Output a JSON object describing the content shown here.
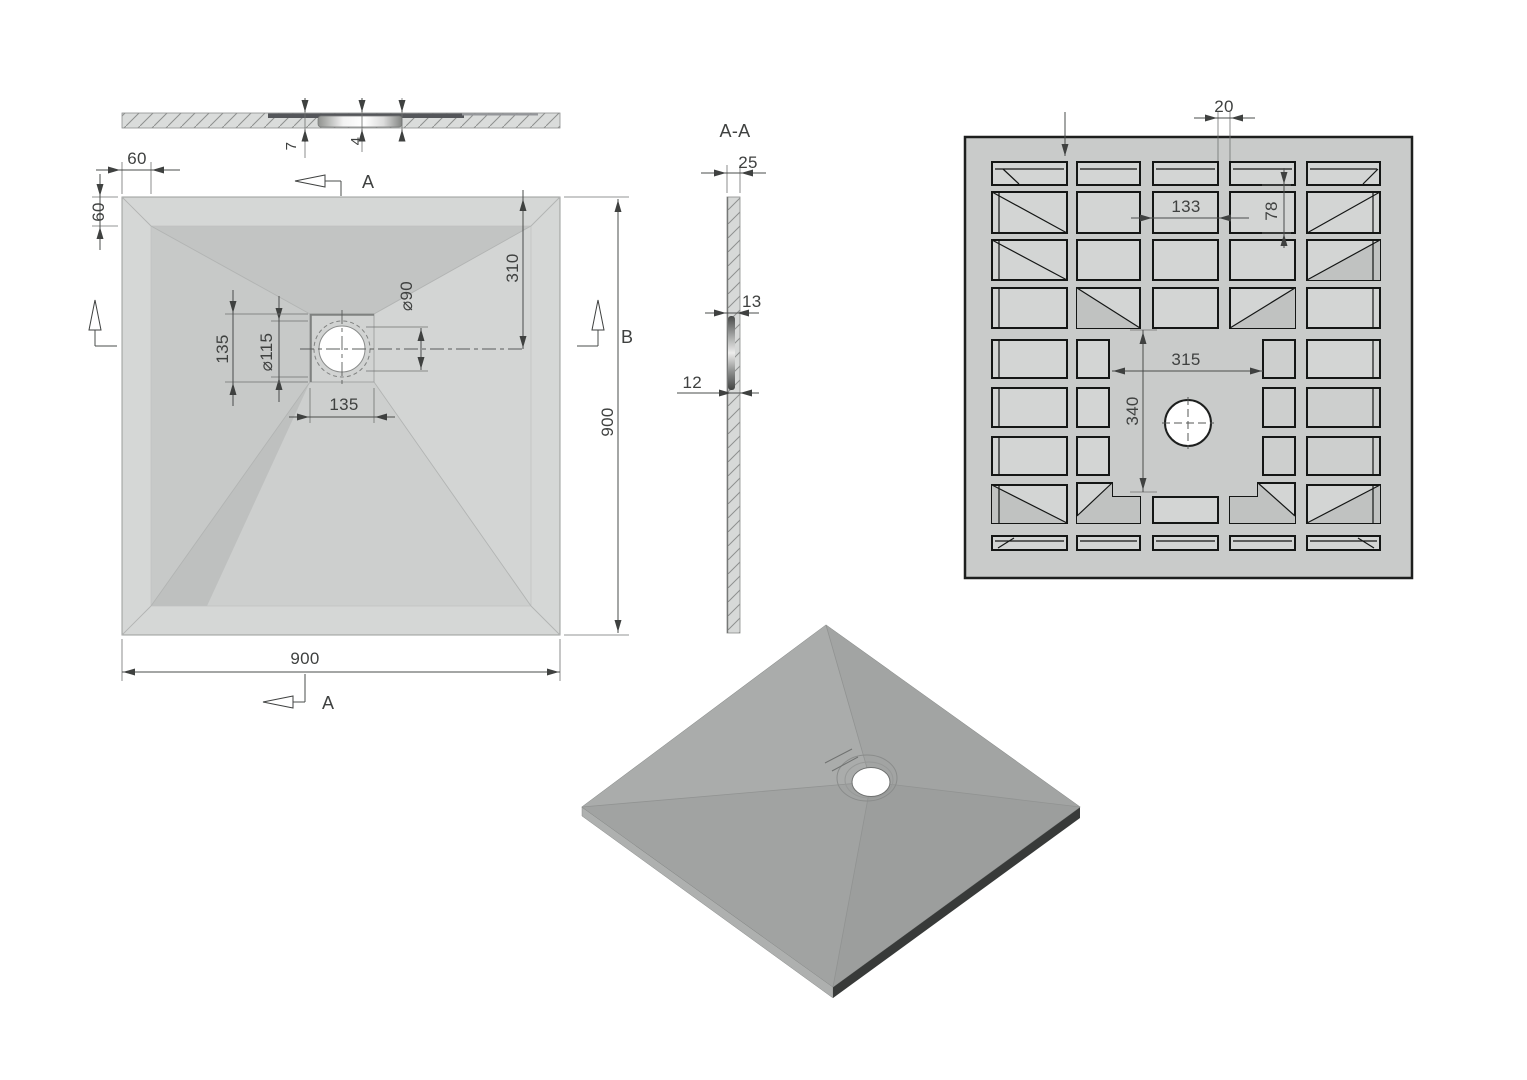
{
  "labels": {
    "front": {
      "depth_7": "7",
      "depth_4": "4"
    },
    "plan": {
      "edge_offset_top": "60",
      "edge_offset_left": "60",
      "edge_offset_bottom": "60",
      "drain_from_top": "310",
      "drain_hole_dia": "⌀90",
      "flange_dia": "⌀115",
      "drain_box_h": "135",
      "drain_box_w": "135",
      "width": "900",
      "height": "900",
      "section_a_top": "A",
      "section_a_bottom": "A",
      "section_b": "B"
    },
    "section": {
      "title": "A-A",
      "thickness_25": "25",
      "step_13": "13",
      "step_12": "12"
    },
    "bottom": {
      "rib_20": "20",
      "pocket_w_133": "133",
      "pocket_h_78": "78",
      "center_w_315": "315",
      "center_h_340": "340"
    },
    "colors": {
      "line": "#3f4140",
      "plate": "#c9cbca",
      "pocket": "#d3d5d4",
      "facet_dark": "#c2c4c3",
      "iso_top": "#a5a7a6",
      "iso_edge_dark": "#383a39",
      "drain_white": "#ffffff"
    }
  }
}
